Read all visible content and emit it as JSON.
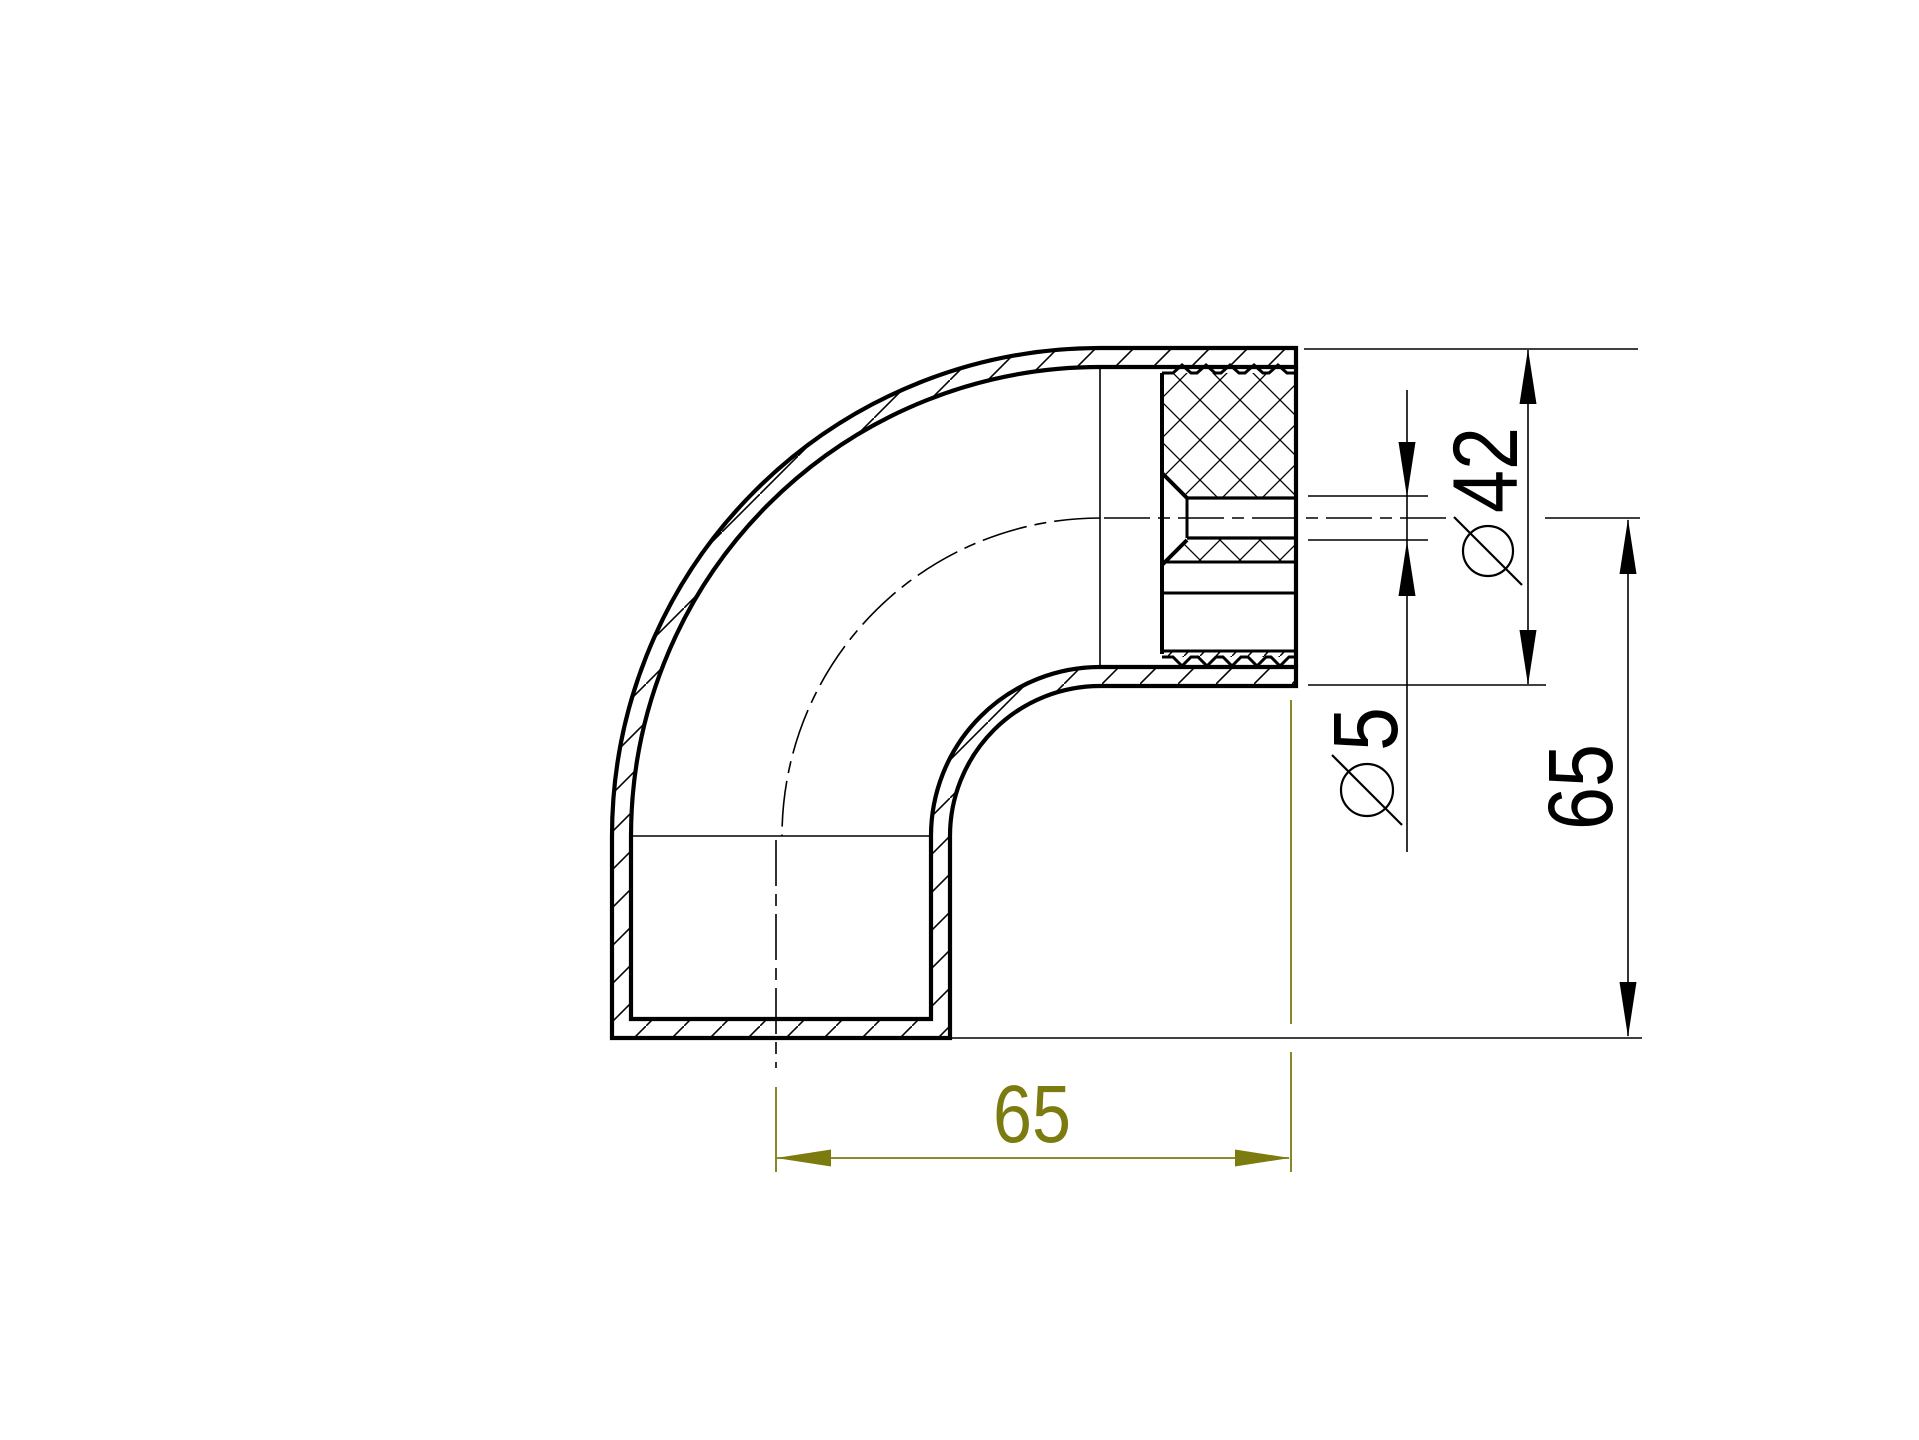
{
  "canvas": {
    "background": "#ffffff",
    "line_color": "#000000",
    "dimension_accent_color": "#7b7b10"
  },
  "dimensions": {
    "outer_diameter": {
      "display": "Ø42",
      "digits": "42",
      "symbol": "diameter"
    },
    "hole_diameter": {
      "display": "Ø5",
      "digits": "5",
      "symbol": "diameter"
    },
    "vertical_length": {
      "display": "65",
      "digits": "65"
    },
    "horizontal_length": {
      "display": "65",
      "digits": "65"
    }
  }
}
